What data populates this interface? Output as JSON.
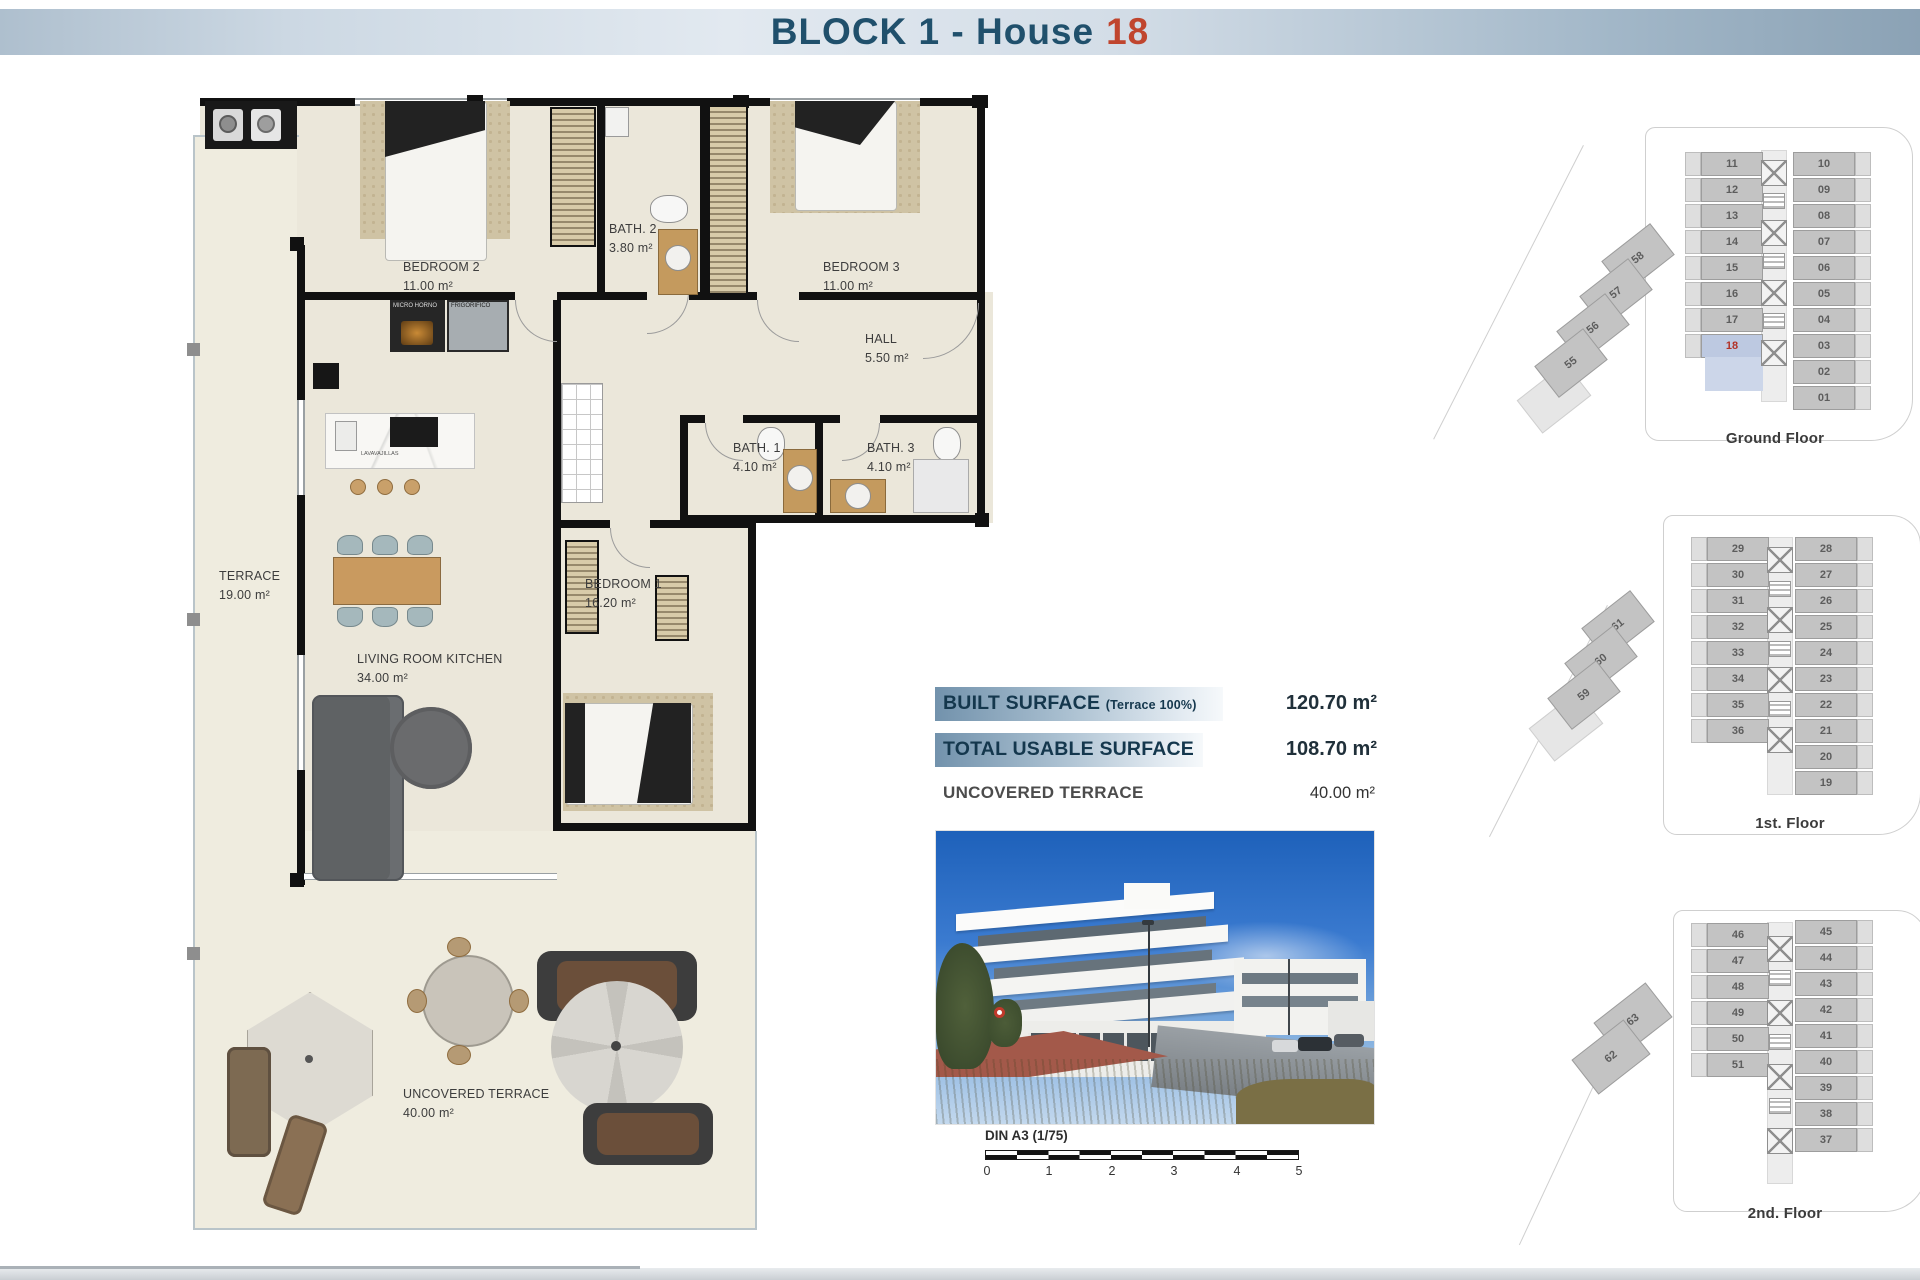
{
  "header": {
    "title_prefix": "BLOCK 1 - House",
    "house_number": "18"
  },
  "floorplan": {
    "rooms": [
      {
        "name": "BEDROOM 2",
        "area": "11.00 m²"
      },
      {
        "name": "BATH. 2",
        "area": "3.80 m²"
      },
      {
        "name": "BEDROOM 3",
        "area": "11.00 m²"
      },
      {
        "name": "HALL",
        "area": "5.50 m²"
      },
      {
        "name": "BATH. 1",
        "area": "4.10 m²"
      },
      {
        "name": "BATH. 3",
        "area": "4.10 m²"
      },
      {
        "name": "TERRACE",
        "area": "19.00 m²"
      },
      {
        "name": "BEDROOM 1",
        "area": "16.20 m²"
      },
      {
        "name": "LIVING ROOM KITCHEN",
        "area": "34.00 m²"
      },
      {
        "name": "UNCOVERED TERRACE",
        "area": "40.00 m²"
      }
    ],
    "appliances": {
      "oven": "MICRO HORNO",
      "fridge": "FRIGORIFICO",
      "dishwasher": "LAVAVAJILLAS"
    }
  },
  "surface_table": {
    "rows": [
      {
        "label": "BUILT SURFACE",
        "note": "(Terrace 100%)",
        "value": "120.70 m²",
        "bar": true
      },
      {
        "label": "TOTAL USABLE SURFACE",
        "note": "",
        "value": "108.70 m²",
        "bar": true
      },
      {
        "label": "UNCOVERED TERRACE",
        "note": "",
        "value": "40.00 m²",
        "bar": false
      }
    ]
  },
  "scale_bar": {
    "label": "DIN A3 (1/75)",
    "ticks": [
      "0",
      "1",
      "2",
      "3",
      "4",
      "5"
    ]
  },
  "site_plans": [
    {
      "caption": "Ground Floor",
      "left_units": [
        "11",
        "12",
        "13",
        "14",
        "15",
        "16",
        "17",
        "18"
      ],
      "right_units": [
        "10",
        "09",
        "08",
        "07",
        "06",
        "05",
        "04",
        "03",
        "02",
        "01"
      ],
      "diagonal_units": [
        "58",
        "57",
        "56",
        "55"
      ],
      "highlight_unit": "18"
    },
    {
      "caption": "1st. Floor",
      "left_units": [
        "29",
        "30",
        "31",
        "32",
        "33",
        "34",
        "35",
        "36"
      ],
      "right_units": [
        "28",
        "27",
        "26",
        "25",
        "24",
        "23",
        "22",
        "21",
        "20",
        "19"
      ],
      "diagonal_units": [
        "61",
        "60",
        "59"
      ],
      "highlight_unit": ""
    },
    {
      "caption": "2nd. Floor",
      "left_units": [
        "46",
        "47",
        "48",
        "49",
        "50",
        "51"
      ],
      "right_units": [
        "45",
        "44",
        "43",
        "42",
        "41",
        "40",
        "39",
        "38",
        "37"
      ],
      "diagonal_units": [
        "63",
        "62"
      ],
      "highlight_unit": ""
    }
  ],
  "colors": {
    "title_blue": "#20506c",
    "house_number_red": "#c0452e",
    "table_bar_blue": "#7292ac",
    "highlight_unit_bg": "#bdc9e1",
    "highlight_unit_red": "#b23227",
    "plan_floor": "#ebe7da",
    "plan_wall": "#111111"
  }
}
